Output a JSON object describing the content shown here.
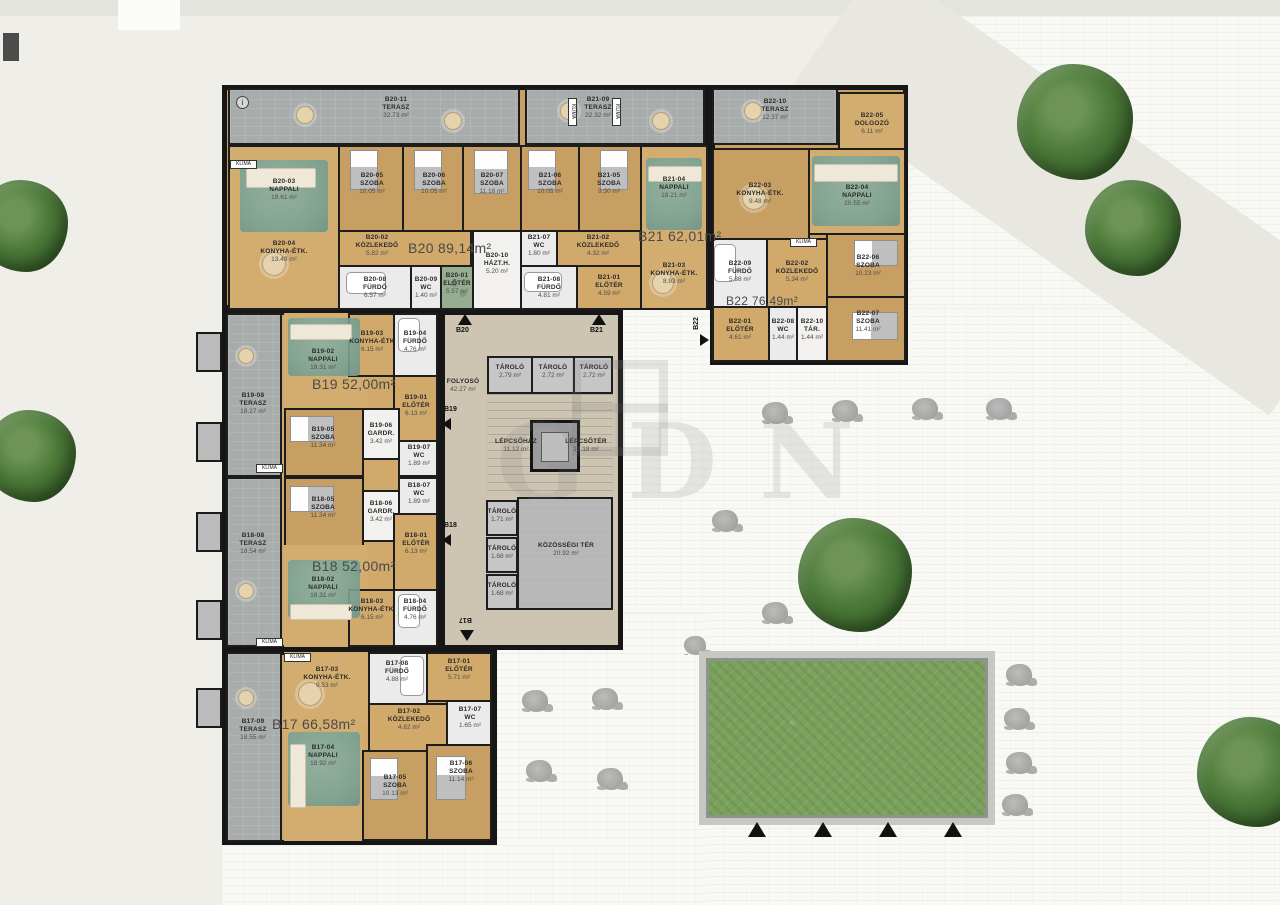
{
  "watermark": {
    "text": "GDN"
  },
  "labels": {
    "klima": "KLÍMA",
    "info": "i"
  },
  "markers": {
    "b17": "B17",
    "b18": "B18",
    "b19": "B19",
    "b20": "B20",
    "b21": "B21",
    "b22": "B22"
  },
  "common": {
    "folyoso": {
      "name": "FOLYOSÓ",
      "area": "42.27 m²"
    },
    "lepcsohaz": {
      "name": "LÉPCSŐHÁZ",
      "area": "11.12 m²"
    },
    "lepcsoter": {
      "name": "LÉPCSŐTÉR",
      "area": "12.18 m²"
    },
    "kozossegi": {
      "name": "KÖZÖSSÉGI TÉR",
      "area": "20.92 m²"
    },
    "tarolok_felso": [
      {
        "name": "TÁROLÓ",
        "area": "2.79 m²"
      },
      {
        "name": "TÁROLÓ",
        "area": "2.72 m²"
      },
      {
        "name": "TÁROLÓ",
        "area": "2.72 m²"
      }
    ],
    "tarolok_also": [
      {
        "name": "TÁROLÓ",
        "area": "1.71 m²"
      },
      {
        "name": "TÁROLÓ",
        "area": "1.68 m²"
      },
      {
        "name": "TÁROLÓ",
        "area": "1.68 m²"
      }
    ]
  },
  "apartments": {
    "b17": {
      "total": "B17 66,58m²",
      "rooms": [
        {
          "id": "B17-01",
          "name": "ELŐTÉR",
          "area": "5.71 m²"
        },
        {
          "id": "B17-02",
          "name": "KÖZLEKEDŐ",
          "area": "4.62 m²"
        },
        {
          "id": "B17-03",
          "name": "KONYHA-ÉTK.",
          "area": "9.53 m²"
        },
        {
          "id": "B17-04",
          "name": "NAPPALI",
          "area": "18.92 m²"
        },
        {
          "id": "B17-05",
          "name": "SZOBA",
          "area": "10.13 m²"
        },
        {
          "id": "B17-06",
          "name": "SZOBA",
          "area": "11.14 m²"
        },
        {
          "id": "B17-07",
          "name": "WC",
          "area": "1.65 m²"
        },
        {
          "id": "B17-08",
          "name": "FÜRDŐ",
          "area": "4.88 m²"
        },
        {
          "id": "B17-09",
          "name": "TERASZ",
          "area": "18.55 m²"
        }
      ]
    },
    "b18": {
      "total": "B18 52,00m²",
      "rooms": [
        {
          "id": "B18-01",
          "name": "ELŐTÉR",
          "area": "6.13 m²"
        },
        {
          "id": "B18-02",
          "name": "NAPPALI",
          "area": "18.31 m²"
        },
        {
          "id": "B18-03",
          "name": "KONYHA-ÉTK.",
          "area": "6.15 m²"
        },
        {
          "id": "B18-04",
          "name": "FÜRDŐ",
          "area": "4.76 m²"
        },
        {
          "id": "B18-05",
          "name": "SZOBA",
          "area": "11.34 m²"
        },
        {
          "id": "B18-06",
          "name": "GARDR.",
          "area": "3.42 m²"
        },
        {
          "id": "B18-07",
          "name": "WC",
          "area": "1.89 m²"
        },
        {
          "id": "B18-08",
          "name": "TERASZ",
          "area": "18.54 m²"
        }
      ]
    },
    "b19": {
      "total": "B19 52,00m²",
      "rooms": [
        {
          "id": "B19-01",
          "name": "ELŐTÉR",
          "area": "6.13 m²"
        },
        {
          "id": "B19-02",
          "name": "NAPPALI",
          "area": "18.31 m²"
        },
        {
          "id": "B19-03",
          "name": "KONYHA-ÉTK",
          "area": "6.15 m²"
        },
        {
          "id": "B19-04",
          "name": "FÜRDŐ",
          "area": "4.76 m²"
        },
        {
          "id": "B19-05",
          "name": "SZOBA",
          "area": "11.34 m²"
        },
        {
          "id": "B19-06",
          "name": "GARDR.",
          "area": "3.42 m²"
        },
        {
          "id": "B19-07",
          "name": "WC",
          "area": "1.89 m²"
        },
        {
          "id": "B19-08",
          "name": "TERASZ",
          "area": "18.27 m²"
        }
      ]
    },
    "b20": {
      "total": "B20 89,14m²",
      "rooms": [
        {
          "id": "B20-01",
          "name": "ELŐTÉR",
          "area": "5.57 m²"
        },
        {
          "id": "B20-02",
          "name": "KÖZLEKEDŐ",
          "area": "5.82 m²"
        },
        {
          "id": "B20-03",
          "name": "NAPPALI",
          "area": "19.61 m²"
        },
        {
          "id": "B20-04",
          "name": "KONYHA-ÉTK.",
          "area": "13.49 m²"
        },
        {
          "id": "B20-05",
          "name": "SZOBA",
          "area": "10.05 m²"
        },
        {
          "id": "B20-06",
          "name": "SZOBA",
          "area": "10.05 m²"
        },
        {
          "id": "B20-07",
          "name": "SZOBA",
          "area": "11.18 m²"
        },
        {
          "id": "B20-08",
          "name": "FÜRDŐ",
          "area": "6.57 m²"
        },
        {
          "id": "B20-09",
          "name": "WC",
          "area": "1.40 m²"
        },
        {
          "id": "B20-10",
          "name": "HÁZT.H.",
          "area": "5.20 m²"
        },
        {
          "id": "B20-11",
          "name": "TERASZ",
          "area": "32.73 m²"
        }
      ]
    },
    "b21": {
      "total": "B21 62,01m²",
      "rooms": [
        {
          "id": "B21-01",
          "name": "ELŐTÉR",
          "area": "4.59 m²"
        },
        {
          "id": "B21-02",
          "name": "KÖZLEKEDŐ",
          "area": "4.32 m²"
        },
        {
          "id": "B21-03",
          "name": "KONYHA-ÉTK.",
          "area": "8.93 m²"
        },
        {
          "id": "B21-04",
          "name": "NAPPALI",
          "area": "18.21 m²"
        },
        {
          "id": "B21-05",
          "name": "SZOBA",
          "area": "9.30 m²"
        },
        {
          "id": "B21-06",
          "name": "SZOBA",
          "area": "10.05 m²"
        },
        {
          "id": "B21-07",
          "name": "WC",
          "area": "1.80 m²"
        },
        {
          "id": "B21-08",
          "name": "FÜRDŐ",
          "area": "4.81 m²"
        },
        {
          "id": "B21-09",
          "name": "TERASZ",
          "area": "22.32 m²"
        }
      ]
    },
    "b22": {
      "total": "B22 76,49m²",
      "rooms": [
        {
          "id": "B22-01",
          "name": "ELŐTÉR",
          "area": "4.61 m²"
        },
        {
          "id": "B22-02",
          "name": "KÖZLEKEDŐ",
          "area": "5.34 m²"
        },
        {
          "id": "B22-03",
          "name": "KONYHA-ÉTK.",
          "area": "9.48 m²"
        },
        {
          "id": "B22-04",
          "name": "NAPPALI",
          "area": "20.55 m²"
        },
        {
          "id": "B22-05",
          "name": "DOLGOZÓ",
          "area": "6.11 m²"
        },
        {
          "id": "B22-06",
          "name": "SZOBA",
          "area": "10.23 m²"
        },
        {
          "id": "B22-07",
          "name": "SZOBA",
          "area": "11.41 m²"
        },
        {
          "id": "B22-08",
          "name": "WC",
          "area": "1.44 m²"
        },
        {
          "id": "B22-09",
          "name": "FÜRDŐ",
          "area": "5.88 m²"
        },
        {
          "id": "B22-10",
          "name": "TÁR.",
          "area": "1.44 m²"
        },
        {
          "id": "B22-10",
          "name": "TERASZ",
          "area": "12.37 m²"
        }
      ]
    }
  }
}
